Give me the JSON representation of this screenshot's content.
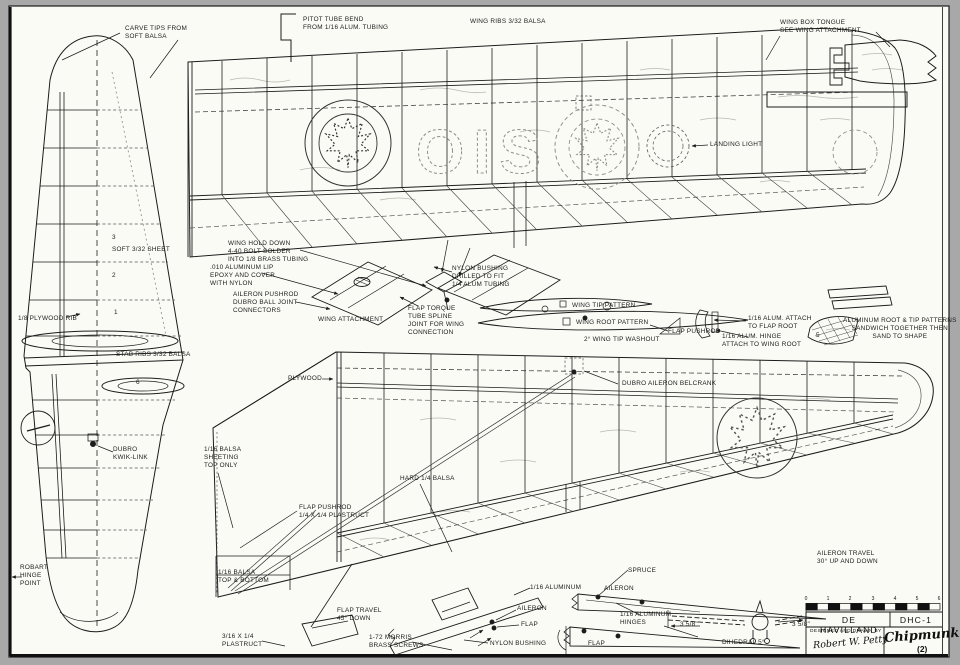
{
  "page": {
    "background": "#a8a8a8",
    "paper": "#fbfbf6",
    "ink": "#1c1c1c"
  },
  "registration": {
    "letters": "OIS"
  },
  "title_block": {
    "manufacturer": "DE HAVILLAND",
    "model": "DHC-1",
    "designed_by_label": "DESIGNED AND DRAWN BY",
    "designer_signature": "Robert W. Petty",
    "plane_name": "Chipmunk",
    "sheet_number": "(2)",
    "scale_numbers": [
      "0",
      "1",
      "2",
      "3",
      "4",
      "5",
      "6"
    ]
  },
  "labels": [
    {
      "name": "label-carve-tips",
      "x": 125,
      "y": 25,
      "text": "CARVE TIPS FROM\nSOFT BALSA"
    },
    {
      "name": "label-pitot-tube",
      "x": 303,
      "y": 16,
      "text": "PITOT TUBE BEND\nFROM 1/16 ALUM. TUBING"
    },
    {
      "name": "label-wing-ribs",
      "x": 470,
      "y": 18,
      "text": "WING RIBS 3/32 BALSA"
    },
    {
      "name": "label-wing-box-tongue",
      "x": 780,
      "y": 19,
      "text": "WING BOX TONGUE\nSEE WING ATTACHMENT"
    },
    {
      "name": "label-landing-light",
      "x": 710,
      "y": 141,
      "text": "LANDING LIGHT"
    },
    {
      "name": "label-soft-sheet",
      "x": 112,
      "y": 246,
      "text": "SOFT 3/32 SHEET"
    },
    {
      "name": "label-plywood-rib",
      "x": 18,
      "y": 315,
      "text": "1/8 PLYWOOD RIB"
    },
    {
      "name": "label-stab-ribs",
      "x": 116,
      "y": 351,
      "text": "STAB RIBS 3/32 BALSA"
    },
    {
      "name": "label-dubro-kwik-link",
      "x": 113,
      "y": 446,
      "text": "DUBRO\nKWIK-LINK"
    },
    {
      "name": "label-robart-hinge-point",
      "x": 20,
      "y": 564,
      "text": "ROBART\nHINGE\nPOINT"
    },
    {
      "name": "label-wing-hold-down",
      "x": 228,
      "y": 240,
      "text": "WING HOLD DOWN\n4-40 BOLT SOLDER\nINTO 1/8 BRASS TUBING"
    },
    {
      "name": "label-aluminum-lip",
      "x": 210,
      "y": 264,
      "text": ".010 ALUMINUM LIP\nEPOXY AND COVER\nWITH NYLON"
    },
    {
      "name": "label-aileron-pushrod-connectors",
      "x": 233,
      "y": 291,
      "text": "AILERON PUSHROD\nDUBRO BALL JOINT\nCONNECTORS"
    },
    {
      "name": "label-wing-attachment",
      "x": 318,
      "y": 316,
      "text": "WING ATTACHMENT"
    },
    {
      "name": "label-flap-torque-tube",
      "x": 408,
      "y": 305,
      "text": "FLAP TORQUE\nTUBE SPLINE\nJOINT FOR WING\nCONNECTION"
    },
    {
      "name": "label-nylon-bushing-drilled",
      "x": 452,
      "y": 265,
      "text": "NYLON BUSHING\nDRILLED TO FIT\n1/4 ALUM TUBING"
    },
    {
      "name": "label-wing-tip-pattern",
      "x": 572,
      "y": 302,
      "text": "WING TIP    PATTERN"
    },
    {
      "name": "label-wing-root-pattern",
      "x": 576,
      "y": 319,
      "text": "WING ROOT PATTERN"
    },
    {
      "name": "label-wing-tip-washout",
      "x": 584,
      "y": 336,
      "text": "2° WING TIP WASHOUT"
    },
    {
      "name": "label-flap-pushrod",
      "x": 668,
      "y": 328,
      "text": "FLAP PUSHROD"
    },
    {
      "name": "label-alum-attach-flap-root",
      "x": 748,
      "y": 315,
      "text": "1/16 ALUM. ATTACH\nTO FLAP ROOT"
    },
    {
      "name": "label-alum-hinge-wing-root",
      "x": 722,
      "y": 333,
      "text": "1/16 ALUM. HINGE\nATTACH TO WING ROOT"
    },
    {
      "name": "label-aluminum-patterns",
      "x": 843,
      "y": 317,
      "align": "center",
      "text": "ALUMINUM ROOT & TIP PATTERNS\nSANDWICH TOGETHER THEN\nSAND TO SHAPE"
    },
    {
      "name": "label-plywood",
      "x": 288,
      "y": 375,
      "text": "PLYWOOD"
    },
    {
      "name": "label-dubro-aileron-belcrank",
      "x": 622,
      "y": 380,
      "text": "DUBRO AILERON BELCRANK"
    },
    {
      "name": "label-balsa-sheeting-top",
      "x": 204,
      "y": 446,
      "text": "1/16 BALSA\nSHEETING\nTOP ONLY"
    },
    {
      "name": "label-hard-balsa",
      "x": 400,
      "y": 475,
      "text": "HARD 1/4 BALSA"
    },
    {
      "name": "label-flap-pushrod-plastruct",
      "x": 299,
      "y": 504,
      "text": "FLAP PUSHROD\n1/4 X 1/4 PLASTRUCT"
    },
    {
      "name": "label-balsa-top-bottom",
      "x": 218,
      "y": 569,
      "text": "1/16 BALSA\nTOP & BOTTOM"
    },
    {
      "name": "label-plastruct",
      "x": 222,
      "y": 633,
      "text": "3/16 X 1/4\nPLASTRUCT"
    },
    {
      "name": "label-flap-travel",
      "x": 337,
      "y": 607,
      "text": "FLAP TRAVEL\n45° DOWN"
    },
    {
      "name": "label-morris-screws",
      "x": 369,
      "y": 634,
      "text": "1-72 MORRIS\nBRASS SCREWS"
    },
    {
      "name": "label-sixteenth-aluminum",
      "x": 530,
      "y": 584,
      "text": "1/16 ALUMINUM"
    },
    {
      "name": "label-aileron-detail",
      "x": 517,
      "y": 605,
      "text": "AILERON"
    },
    {
      "name": "label-flap-detail",
      "x": 521,
      "y": 621,
      "text": "FLAP"
    },
    {
      "name": "label-nylon-bushing",
      "x": 490,
      "y": 640,
      "text": "NYLON BUSHING"
    },
    {
      "name": "label-spruce",
      "x": 628,
      "y": 567,
      "text": "SPRUCE"
    },
    {
      "name": "label-aileron-plan",
      "x": 604,
      "y": 585,
      "text": "AILERON"
    },
    {
      "name": "label-aluminum-hinges",
      "x": 620,
      "y": 611,
      "text": "1/16 ALUMINUM\nHINGES"
    },
    {
      "name": "label-flap-plan",
      "x": 588,
      "y": 640,
      "text": "FLAP"
    },
    {
      "name": "label-dim-left",
      "x": 680,
      "y": 621,
      "text": "3 5/8\""
    },
    {
      "name": "label-dim-right",
      "x": 792,
      "y": 621,
      "text": "3 5/8\""
    },
    {
      "name": "label-dihedral",
      "x": 722,
      "y": 639,
      "text": "DIHEDRAL 5°"
    },
    {
      "name": "label-aileron-travel",
      "x": 817,
      "y": 550,
      "text": "AILERON TRAVEL\n30° UP AND DOWN"
    },
    {
      "name": "rib-number-3",
      "x": 112,
      "y": 234,
      "text": "3"
    },
    {
      "name": "rib-number-2",
      "x": 112,
      "y": 272,
      "text": "2"
    },
    {
      "name": "rib-number-1",
      "x": 114,
      "y": 309,
      "text": "1"
    },
    {
      "name": "rib-number-6",
      "x": 136,
      "y": 379,
      "text": "6"
    },
    {
      "name": "pattern-number-5",
      "x": 816,
      "y": 332,
      "text": "5"
    }
  ]
}
